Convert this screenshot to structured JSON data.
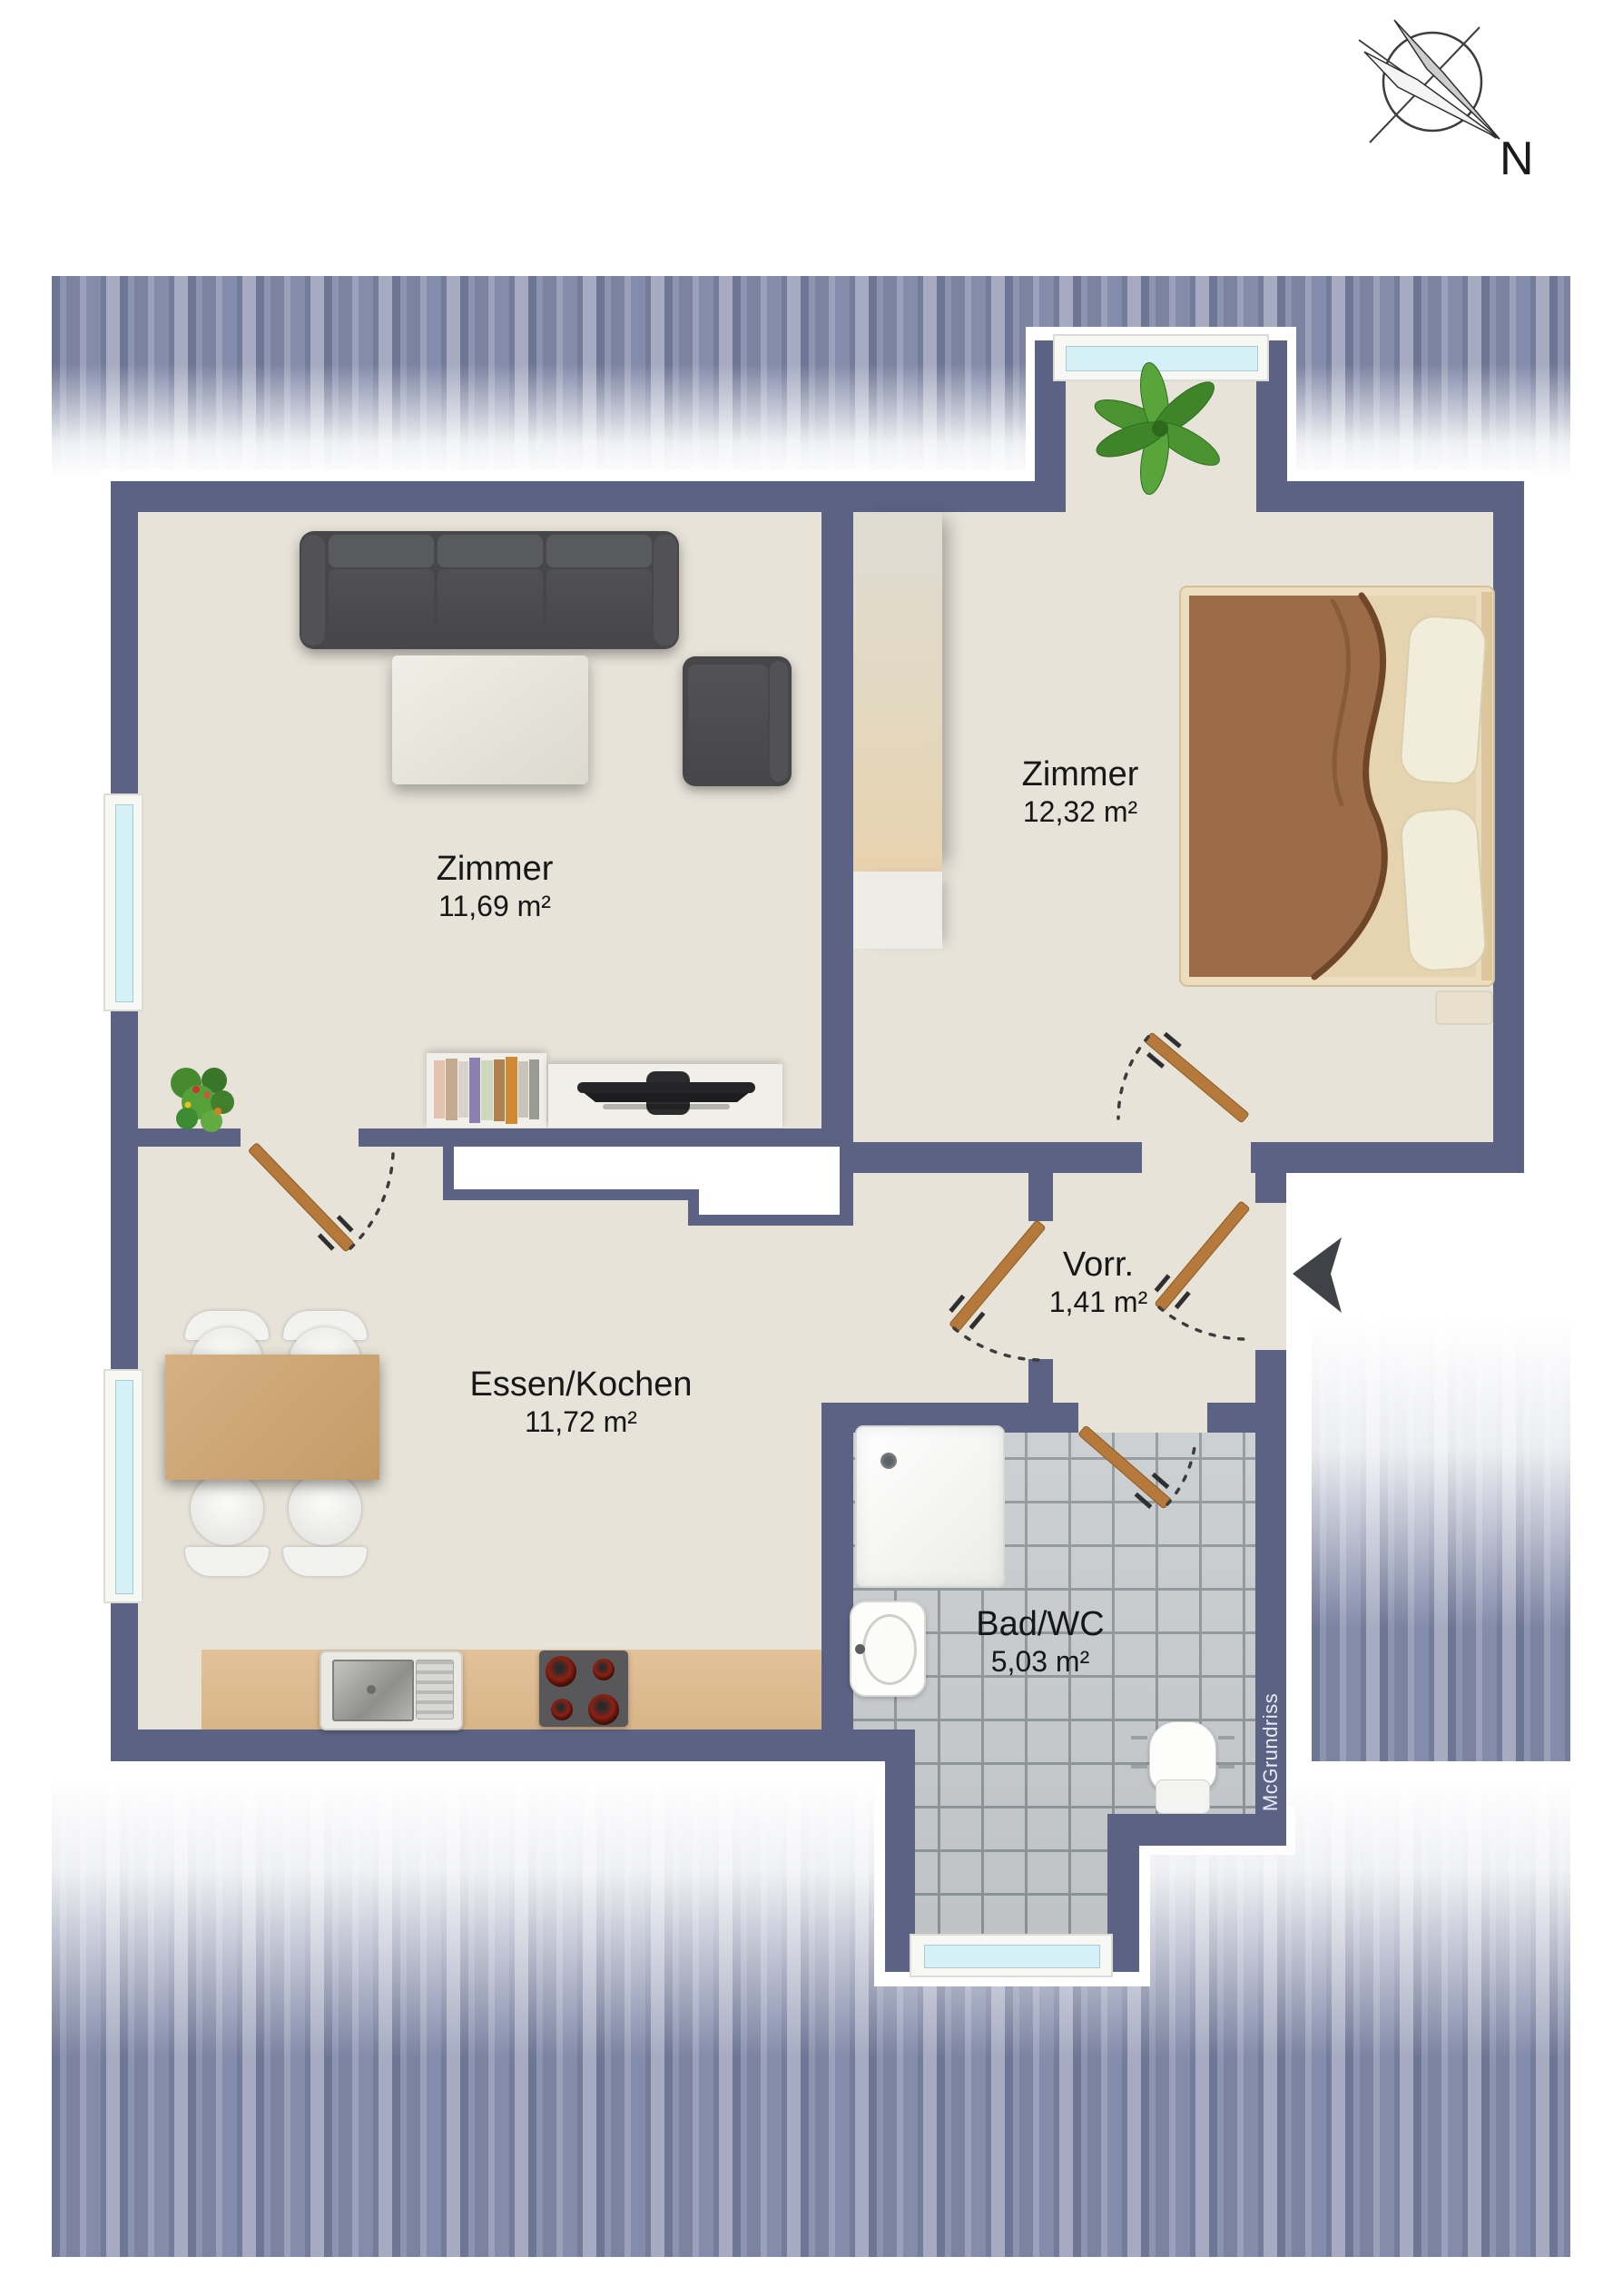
{
  "compass": {
    "north_label": "N"
  },
  "rooms": {
    "living": {
      "name": "Zimmer",
      "area": "11,69 m²"
    },
    "bedroom": {
      "name": "Zimmer",
      "area": "12,32 m²"
    },
    "kitchen": {
      "name": "Essen/Kochen",
      "area": "11,72 m²"
    },
    "hall": {
      "name": "Vorr.",
      "area": "1,41 m²"
    },
    "bath": {
      "name": "Bad/WC",
      "area": "5,03 m²"
    }
  },
  "watermark": "McGrundriss",
  "colors": {
    "wall": "#5b6284",
    "floor": "#e7e3d9",
    "bath_tile": "#c9cdcf",
    "roof_stripe": "#7b83a1",
    "door": "#b5793b",
    "window_glass": "#d6f0f7",
    "kitchen_counter": "#debd94",
    "entry_arrow": "#3f4347"
  }
}
